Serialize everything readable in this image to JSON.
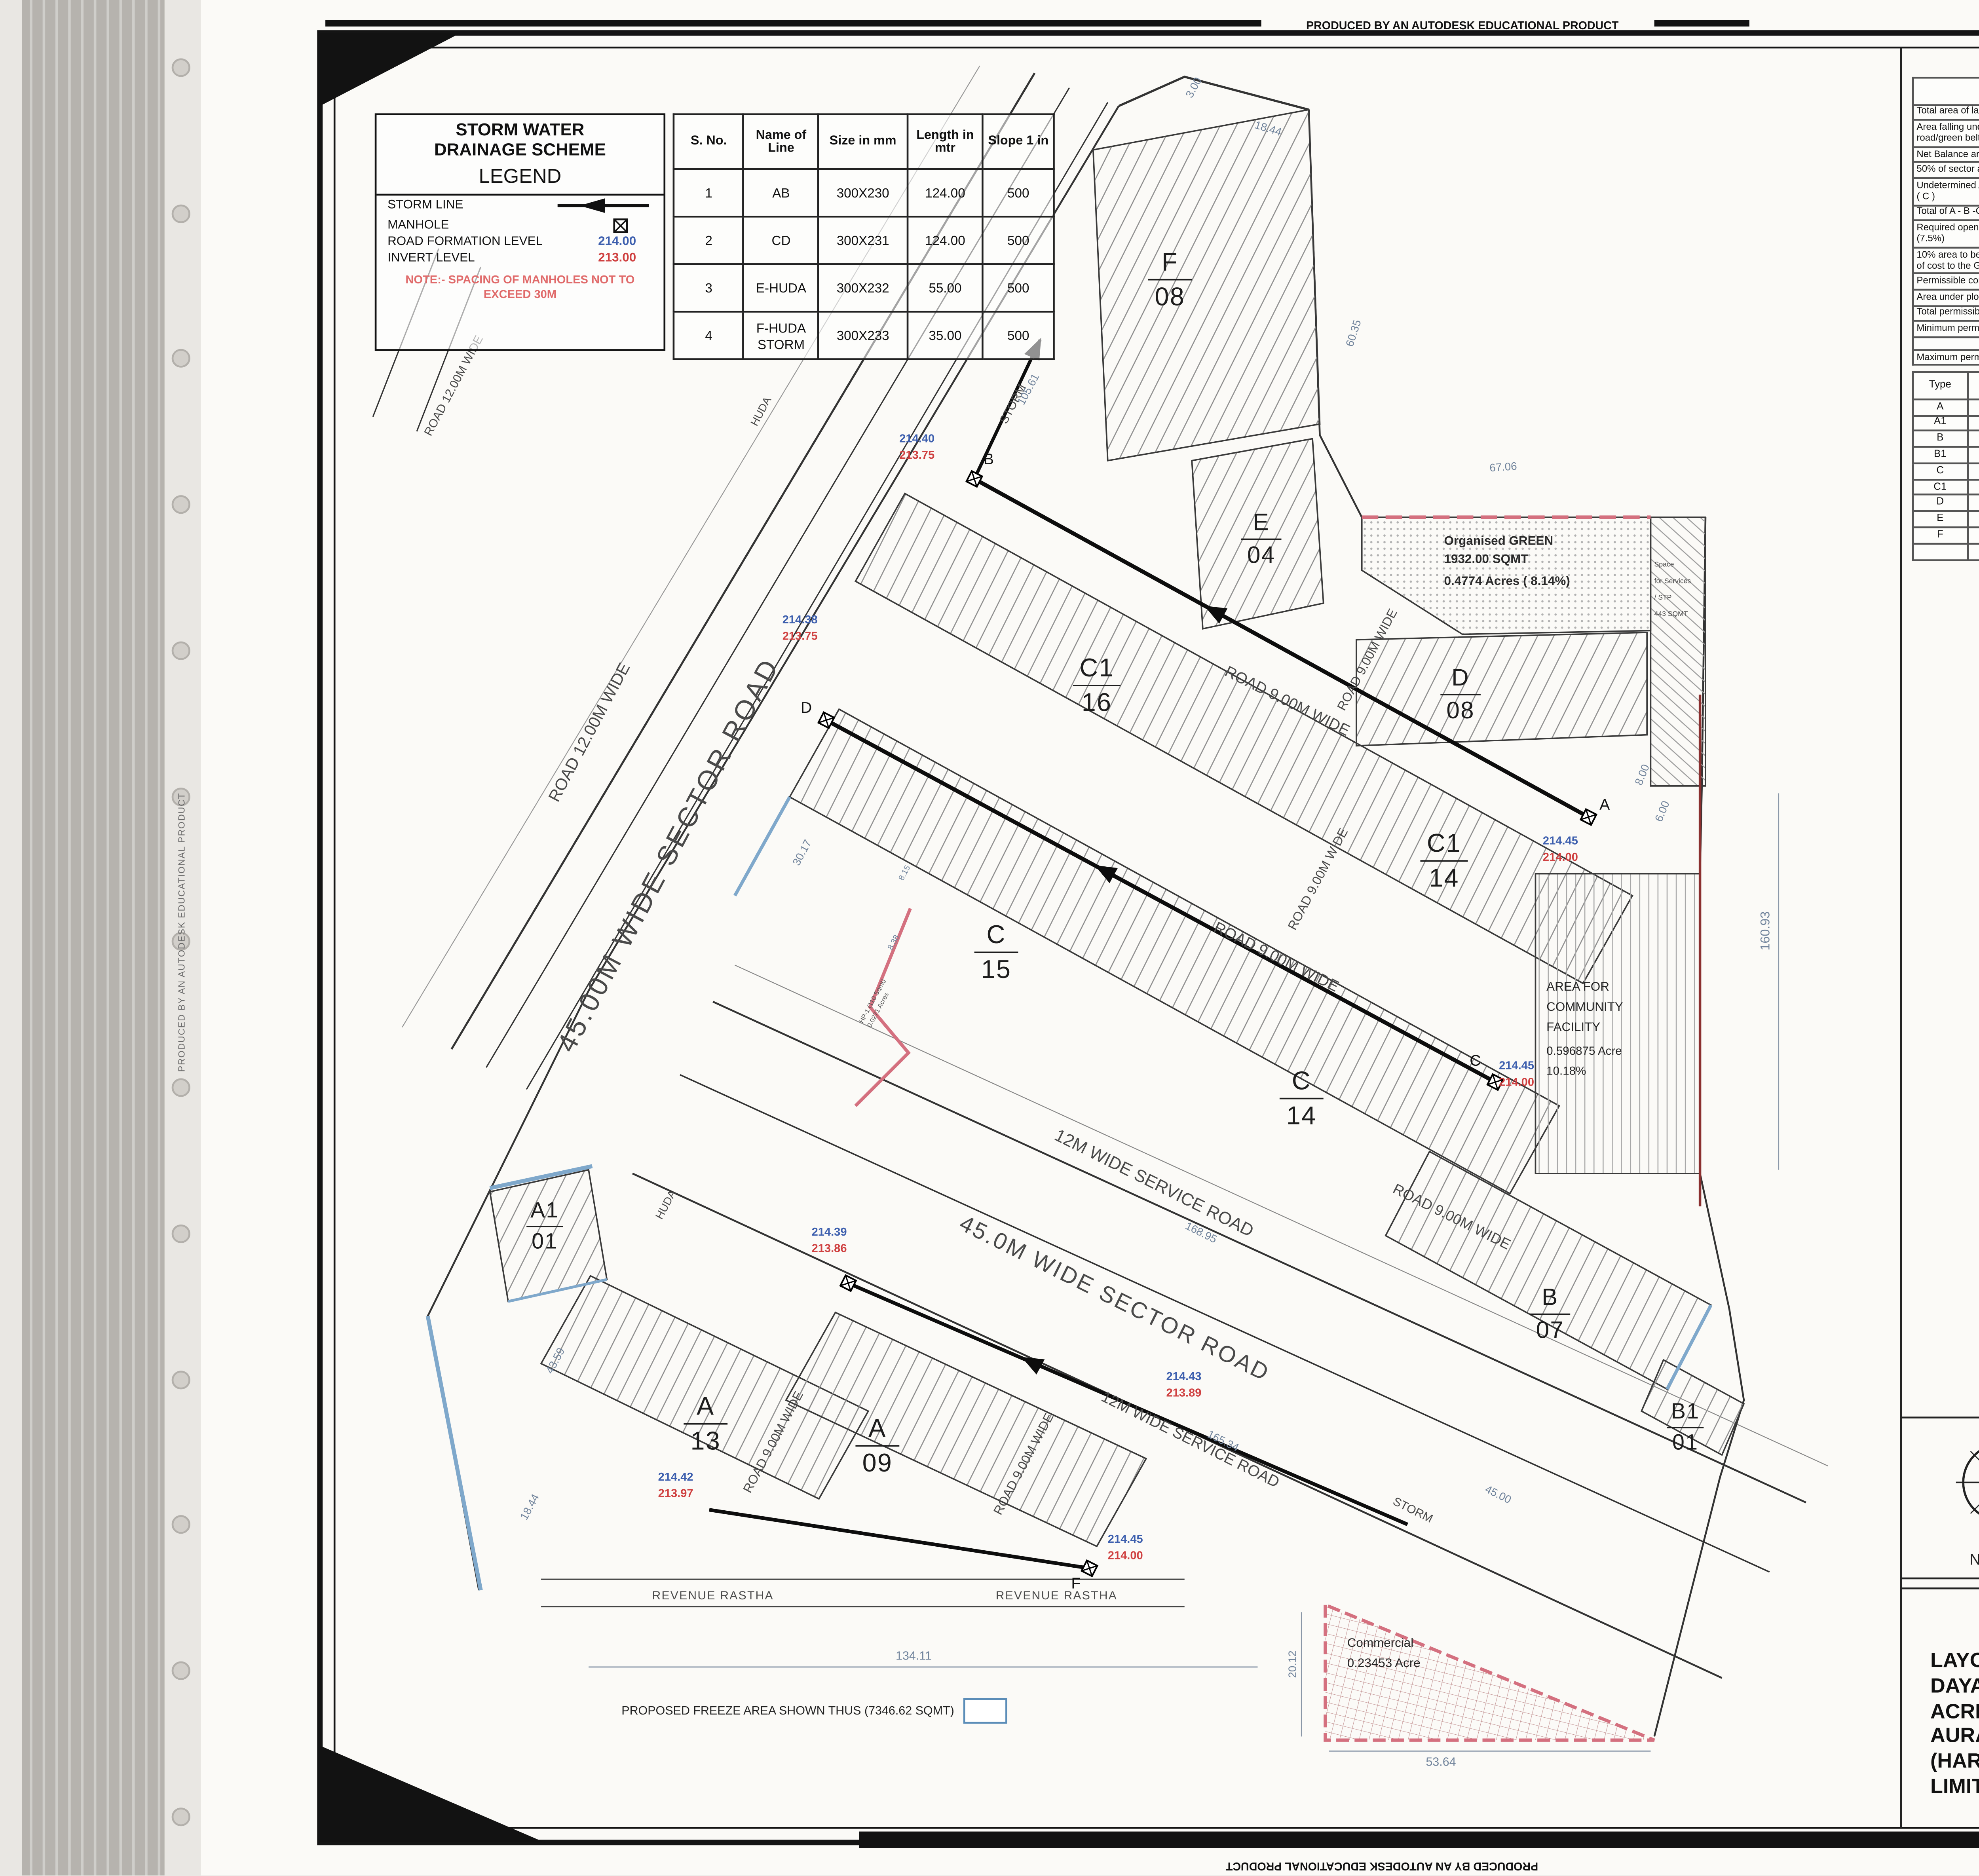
{
  "scan": {
    "producer_text": "PRODUCED BY AN AUTODESK EDUCATIONAL PRODUCT"
  },
  "legend": {
    "title_line1": "STORM WATER",
    "title_line2": "DRAINAGE SCHEME",
    "subtitle": "LEGEND",
    "storm_line_label": "STORM LINE",
    "manhole_label": "MANHOLE",
    "rfl_label": "ROAD FORMATION LEVEL",
    "rfl_value": "214.00",
    "il_label": "INVERT LEVEL",
    "il_value": "213.00",
    "note_line1": "NOTE:- SPACING OF MANHOLES NOT TO",
    "note_line2": "EXCEED 30M"
  },
  "pipe_table": {
    "headers": [
      "S. No.",
      "Name of Line",
      "Size in mm",
      "Length in mtr",
      "Slope 1 in"
    ],
    "rows": [
      [
        "1",
        "AB",
        "300X230",
        "124.00",
        "500"
      ],
      [
        "2",
        "CD",
        "300X231",
        "124.00",
        "500"
      ],
      [
        "3",
        "E-HUDA",
        "300X232",
        "55.00",
        "500"
      ],
      [
        "4",
        "F-HUDA STORM",
        "300X233",
        "35.00",
        "500"
      ]
    ]
  },
  "area_table": {
    "headers": [
      "",
      "Area in acres",
      "Percentage",
      "Proposed area",
      "Percentage"
    ],
    "rows": [
      [
        "Total area of land",
        "5.96875",
        "",
        "",
        ""
      ],
      [
        "Area falling under sector road/green belt",
        "0.00000",
        "",
        "",
        ""
      ],
      [
        "Net Balance area (A)",
        "5.96875",
        "",
        "",
        ""
      ],
      [
        "50% of sector area (B)",
        "0.00000",
        "",
        "",
        ""
      ],
      [
        "Undetermined Area ( I + II + III ) ( C )",
        "0.10560",
        "",
        "",
        ""
      ],
      [
        "Total of A - B -C",
        "5.86315",
        "",
        "",
        ""
      ],
      [
        "Required open space area (7.5%)",
        "0.43974",
        "7.50",
        "0.47740",
        "8.14"
      ],
      [
        "10% area to be transferred free of cost to the Government",
        "0.58632",
        "10.00",
        "0.596875",
        "10.18"
      ],
      [
        "Permissible commercial area",
        "0.23453",
        "4.00",
        "0.23453",
        "4.00"
      ],
      [
        "Area under plots",
        "3.57652",
        "61.00",
        "3.52129",
        "60.09"
      ],
      [
        "Total permissible saleable area",
        "3.81105",
        "65.00",
        "3.75743",
        "64.09"
      ],
      [
        "Minimum permissible density",
        "240.00000",
        "",
        "253.28",
        ""
      ],
      [
        "",
        "",
        "",
        "",
        ""
      ],
      [
        "Maximum permissible density",
        "400.00000",
        "",
        "",
        ""
      ]
    ]
  },
  "plot_table": {
    "headers": [
      "Type",
      "Width",
      "Length",
      "Area",
      "No. of Plots",
      "Total Area under Plots"
    ],
    "rows": [
      [
        "A",
        "7.50",
        "18.00",
        "135",
        "22",
        "2970.00"
      ],
      [
        "A1",
        "IRREGULAR",
        "",
        "77",
        "1",
        "77.00"
      ],
      [
        "B",
        "7.50",
        "20.00",
        "150",
        "7",
        "1050.00"
      ],
      [
        "B1",
        "IRREGULAR",
        "",
        "101",
        "1",
        "101.00"
      ],
      [
        "C",
        "7.14",
        "19.00",
        "135.66",
        "29",
        "3934.14"
      ],
      [
        "C1",
        "7.14",
        "18.00",
        "128.52",
        "30",
        "3855.60"
      ],
      [
        "D",
        "7.23",
        "15.00",
        "108.45",
        "8",
        "867.60"
      ],
      [
        "E",
        "6.18",
        "12.00",
        "74.16",
        "4",
        "296.64"
      ],
      [
        "F",
        "7.08",
        "19.50",
        "138.06",
        "8",
        "1104.48"
      ],
      [
        "",
        "",
        "",
        "",
        "110",
        "14256.46"
      ]
    ]
  },
  "stamps": {
    "lc_no": "LC-3695",
    "exec_l1": "Executive Engineer,",
    "exec_l2": "HSVP, Division,",
    "exec_l3": "Bahadurgarh,",
    "chk_l1": "Checked subject to comments",
    "chk_l2a": "in forwarding letter No.",
    "chk_l2b": "36290",
    "chk_l3a": "Dt.",
    "chk_l3b": "25/02/19",
    "chk_l3c": "and notes",
    "chk_l4": "attached with the estimate",
    "sehq_l1": "Superintending Engineer (HQ)",
    "sehq_l2": "for Chief Engineer HSVP",
    "sehq_l3": "Panchkula",
    "rohtak_l1": "Superintending Engineer",
    "rohtak_l2": "HSVP Circle, Rohtak"
  },
  "licence": {
    "intro_prefix": "To be read with Licence No.",
    "intro_no": "69",
    "intro_mid": "of 2018  Dated",
    "intro_date": "03-10-2018",
    "paragraph": "That this Layout plan for an area measuring 5.96875 acres (Drawing no. DTCP-6583 dated 28.08.2018) comprised of licence which is issued in respect of Affordable Residential Plotted Colony (Under Deen Dayal Jan Awas Yojna) being developed by Microtek Realtors Pvt. Ltd. in Sector-3 & 14, Bahadurgarh is hereby approved subject to the following conditions:-",
    "conditions": [
      "That this Layout Plan shall be read in conjunction with the clauses appearing on the agreement executed under Rule 11 and the bilateral agreement.",
      "That the plotted area of the colony shall not exceed 65% of the net planned area of the colony. The entire area reserved for commercial purposes shall be taken as plotted for calculation of the area under plots.",
      "That the demarcation plans as per site of all the Residential Plots and Commercial site shall be got approved from this Department and construction on these sites shall be governed by the Haryana Building Code, 2017 and the Zoning Plan approved by the Director, Town & Country Planning, Haryana.",
      "That for proper planning and integration of services in the area adjacent to the colony, the colonizer shall abide by the directions of the DTCP for the modification of layout plans of the colony.",
      "That the revenue rasta falling in the colony shall be kept free for circulation/movement as shown in the layout plan.",
      "That the colonizer shall abide by the directions of the DTCP, Haryana and accordingly shall make necessary changes in the layout plan for making any adjustment in the alignment of the peripheral roads, internal road circulation or for proper integration of the planning proposals of the adjoining areas.",
      "That no property/plot shall derive access directly from the carriage way of 30 metres or wider sector road if applicable.",
      "All green belts provided in the layout plan within the licenced areas of the colony shall be developed by the colonizer. All other green belts outside the licenced area shall be developed by the Haryana Urban Development Authority/colonizer on the directions of the Director, Town and Country planning, Haryana or in accordance with terms and conditions of the agreements of the licence.",
      "At the time of demarcation plan, if required … shall be provided by the colonizer in the licenced area.",
      "No plot will derive an access from less than 9 metres wide road would mean a minimum clear width of 9 metres between the plots.",
      "Any excess area over and above the permissible 4% under commercial use shall be deemed to be open space.",
      "The portion of the sector/development plan roads /green belts as provided in the Development Plan if applicable, which form part of the licenced area shall be transferred free of cost to the government on the lines of Section 3(3)(a)(iii) of the Act No.8 of 1975.",
      "That the odd size plots are being approved subject to the conditions that these plots should not have a frontage of less than 75% of the standard frontage when demarcated.",
      "That you will have no objection to the regularization of the boundaries of the licence through give and take with the land that HUDA is finally able to acquire in the interest of planned development and integration of services. The decision of the competent authority shall be binding in this regard.",
      "That the rain water harvesting system shall be provided as per Central Ground Water Authority norms/Haryana Govt. notification as applicable.",
      "That the coloniser/owner shall use only Light-Emitting Diode lamps (LED) fitting for internal lighting as well as Campus lighting.",
      "That the colonizer/owner shall ensure the installation of Solar Power Plant as per provisions of Haryana Solar Power Policy, 2016 issued by Haryana Government Renewable Energy Department vide Notification No. 19/4/2016-5 Power dated 14.03.2016.",
      "That the colonizer/owner shall ensure the installation of Solar Photovoltaic Power Plant as per the provisions of order No.22/52/2005-5Power dated 21.03.2016 issued by Haryana Government Renewable Energy Department.",
      "That the colonizer/owner shall strictly comply with the directions issued vide Notification No. 19/6/2016-5P dated 31.03.2016 issued by Haryana Government Renewable Energy Department for enforcement of the Energy Conservation Building Codes."
    ]
  },
  "signatories": {
    "r1": [
      {
        "name": "(LALIT KUMAR)",
        "title": "DTP (HQ)"
      },
      {
        "name": "(DEVENDRA NIMBOKAR)",
        "title": "STP (M) HQ"
      },
      {
        "name": "(JITENDER SIHAG)",
        "title": "CTP (HR)"
      },
      {
        "name": "(K.MAKRAND PANDURANG, IAS)",
        "title": "DTCP (HR)"
      }
    ],
    "r2": [
      {
        "name": "(RAM AVTAR BASSI)",
        "title": "AD (HQ)"
      },
      {
        "name": "(BALWANT SINGH)",
        "title": "SD (HQ)"
      }
    ]
  },
  "bottom_bar": {
    "north": "NORTH",
    "architect": "ARCHITECT",
    "owner": "OWNER",
    "arch_stamp_1": "Sandeep Agrawa",
    "arch_stamp_2": "CA/2008/42063",
    "owner_stamp_1": "For Microtek Realtors Private Limited",
    "owner_stamp_2": "Director/Auth. Signatory"
  },
  "title_block": {
    "text": "LAYOUT PLAN OF AFFORDABLE PLOTTED  COLONY UNDER DEEN DAYAL JAN AWAS YOJNA - 2016 ON THE LAND  MEASURING 5.96875 ACRES FALLING IN THE REVENUE ESTATE OF VILLAGE SARAI AURANGABAD SECTOR 3 & 14, BAHADURGARH DISTRICT JHAJJAR (HARYANA) BEING DEVELOPED BY MICROTEK REALTORS PRIVATE LIMITED."
  },
  "plan": {
    "freeze_note": "PROPOSED FREEZE AREA SHOWN THUS (7346.62 SQMT)",
    "roads": {
      "sector_upper": "45.00M WIDE SECTOR ROAD",
      "sector_lower": "45.0M WIDE SECTOR ROAD",
      "road12_main": "ROAD 12.00M WIDE",
      "road12_small": "ROAD 12.00M WIDE",
      "road9": "ROAD 9.00M WIDE",
      "service12_a": "12M WIDE SERVICE ROAD",
      "service12_b": "12M WIDE SERVICE ROAD",
      "revenue_a": "REVENUE RASTHA",
      "revenue_b": "REVENUE RASTHA",
      "huda_a": "HUDA",
      "huda_b": "HUDA",
      "storm_top": "STORM",
      "storm_bottom": "STORM"
    },
    "blocks": {
      "f": [
        "F",
        "08"
      ],
      "e": [
        "E",
        "04"
      ],
      "d": [
        "D",
        "08"
      ],
      "c1a": [
        "C1",
        "16"
      ],
      "c1b": [
        "C1",
        "14"
      ],
      "c15": [
        "C",
        "15"
      ],
      "c14": [
        "C",
        "14"
      ],
      "b07": [
        "B",
        "07"
      ],
      "b101": [
        "B1",
        "01"
      ],
      "a101": [
        "A1",
        "01"
      ],
      "a13": [
        "A",
        "13"
      ],
      "a09": [
        "A",
        "09"
      ]
    },
    "areas": {
      "green": [
        "Organised GREEN",
        "1932.00 SQMT",
        "0.4774 Acres ( 8.14%)"
      ],
      "stp": [
        "Space",
        "for Services",
        "/ STP",
        "443 SQMT"
      ],
      "community": [
        "AREA FOR",
        "COMMUNITY",
        "FACILITY",
        "0.596875 Acre",
        "10.18%"
      ],
      "commercial": [
        "Commercial",
        "0.23453 Acre"
      ],
      "hp1": [
        "HP-1 (110 Sqmt)",
        "0.0271 Acres"
      ]
    },
    "levels": {
      "b": [
        "214.40",
        "213.75"
      ],
      "d": [
        "214.38",
        "213.75"
      ],
      "a": [
        "214.45",
        "214.00"
      ],
      "c": [
        "214.45",
        "214.00"
      ],
      "s1": [
        "214.39",
        "213.86"
      ],
      "s2": [
        "214.43",
        "213.89"
      ],
      "s3": [
        "214.42",
        "213.97"
      ],
      "f": [
        "214.45",
        "214.00"
      ]
    },
    "points": {
      "a": "A",
      "b": "B",
      "c": "C",
      "d": "D",
      "f": "F"
    },
    "dims": {
      "d300": "3.00",
      "d1844a": "18.44",
      "d6035": "60.35",
      "d10561": "105.61",
      "d6706": "67.06",
      "d3017": "30.17",
      "d800": "8.00",
      "d600": "6.00",
      "d16093": "160.93",
      "d16895": "168.95",
      "d16534": "165.34",
      "d4359": "43.59",
      "d1844b": "18.44",
      "d13411": "134.11",
      "d2012": "20.12",
      "d5364": "53.64",
      "d4500": "45.00",
      "d815": "8.15",
      "d838": "8.38"
    }
  }
}
